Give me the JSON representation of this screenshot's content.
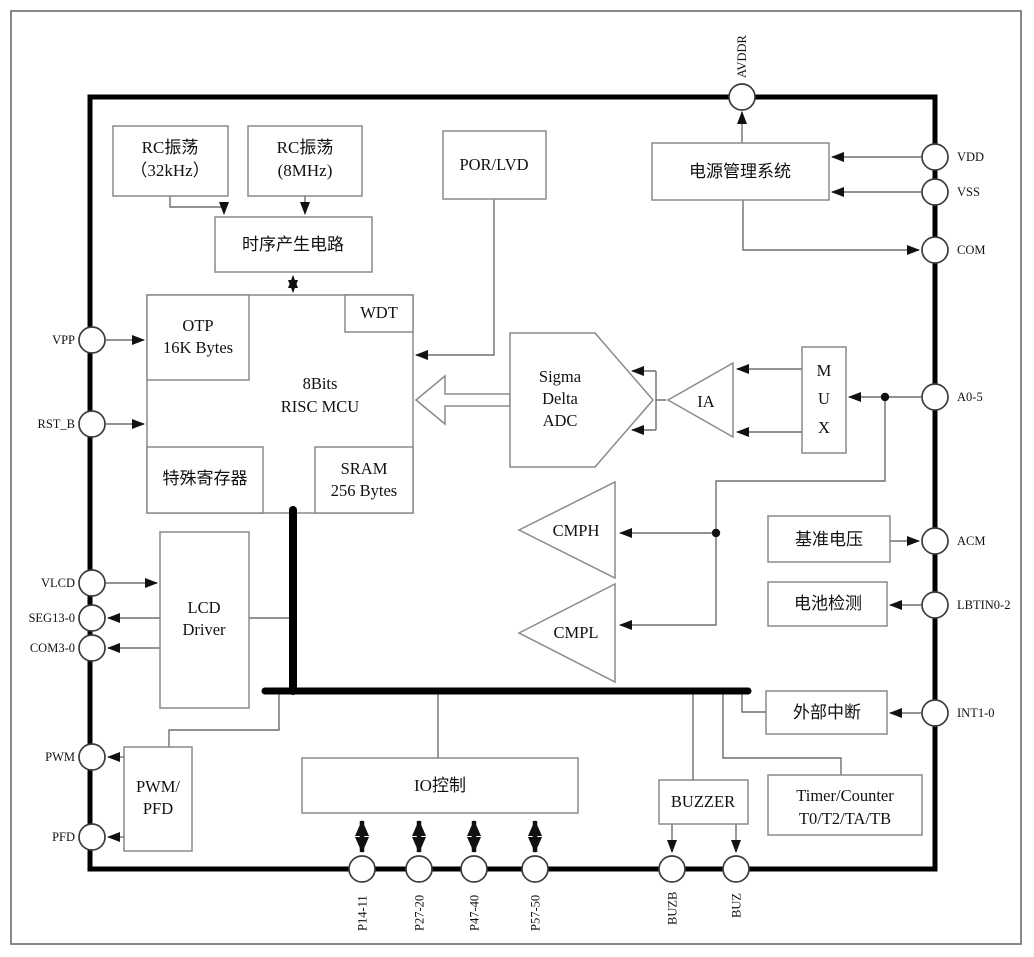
{
  "diagram": {
    "blocks": {
      "rc32": {
        "line1": "RC振荡",
        "line2": "（32kHz）"
      },
      "rc8": {
        "line1": "RC振荡",
        "line2": "(8MHz)"
      },
      "timing": {
        "label": "时序产生电路"
      },
      "por": {
        "label": "POR/LVD"
      },
      "power": {
        "label": "电源管理系统"
      },
      "otp": {
        "line1": "OTP",
        "line2": "16K Bytes"
      },
      "wdt": {
        "label": "WDT"
      },
      "mcu": {
        "line1": "8Bits",
        "line2": "RISC  MCU"
      },
      "sfr": {
        "label": "特殊寄存器"
      },
      "sram": {
        "line1": "SRAM",
        "line2": "256 Bytes"
      },
      "adc": {
        "line1": "Sigma",
        "line2": "Delta",
        "line3": "ADC"
      },
      "ia": {
        "label": "IA"
      },
      "mux": {
        "line1": "M",
        "line2": "U",
        "line3": "X"
      },
      "cmph": {
        "label": "CMPH"
      },
      "cmpl": {
        "label": "CMPL"
      },
      "vref": {
        "label": "基准电压"
      },
      "battery": {
        "label": "电池检测"
      },
      "extint": {
        "label": "外部中断"
      },
      "lcd": {
        "line1": "LCD",
        "line2": "Driver"
      },
      "pwmpfd": {
        "line1": "PWM/",
        "line2": "PFD"
      },
      "iocontrol": {
        "label": "IO控制"
      },
      "buzzer": {
        "label": "BUZZER"
      },
      "timer": {
        "line1": "Timer/Counter",
        "line2": "T0/T2/TA/TB"
      }
    },
    "pins": {
      "avddr": "AVDDR",
      "vdd": "VDD",
      "vss": "VSS",
      "com": "COM",
      "a05": "A0-5",
      "acm": "ACM",
      "lbtin": "LBTIN0-2",
      "int10": "INT1-0",
      "vpp": "VPP",
      "rstb": "RST_B",
      "vlcd": "VLCD",
      "seg": "SEG13-0",
      "com3": "COM3-0",
      "pwm": "PWM",
      "pfd": "PFD",
      "p14": "P14-11",
      "p27": "P27-20",
      "p47": "P47-40",
      "p57": "P57-50",
      "buzb": "BUZB",
      "buz": "BUZ"
    },
    "colors": {
      "background": "#ffffff",
      "chip_border": "#000000",
      "box_border": "#8a8a8a",
      "wire": "#6e6e6e",
      "arrow": "#111111",
      "text": "#111111"
    }
  }
}
